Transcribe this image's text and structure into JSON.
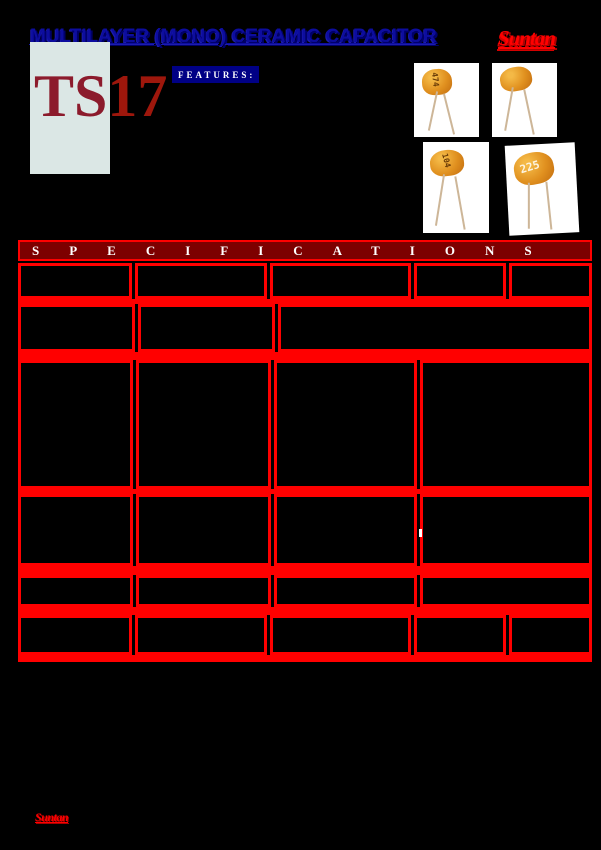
{
  "page": {
    "title": "MULTILAYER (MONO) CERAMIC CAPACITOR",
    "brand_logo": "Suntan",
    "series_prefix": "TS",
    "series_number": "17",
    "features_label": "FEATURES:",
    "footer_brand": "Suntan"
  },
  "products": [
    {
      "marking": "474"
    },
    {
      "marking": ""
    },
    {
      "marking": "104"
    },
    {
      "marking": "225"
    }
  ],
  "spec_table": {
    "heading": "SPECIFICATIONS",
    "rows_columns": [
      5,
      3,
      4,
      4,
      4,
      5
    ],
    "cells_text": ""
  },
  "colors": {
    "accent_red": "#ff0000",
    "heading_maroon": "#7d0000",
    "title_blue": "#0d0d9e",
    "features_navy": "#000085",
    "series_dark_red": "#8c1b2c",
    "page_background": "#000000",
    "ts_box_background": "#dbe7e5"
  }
}
